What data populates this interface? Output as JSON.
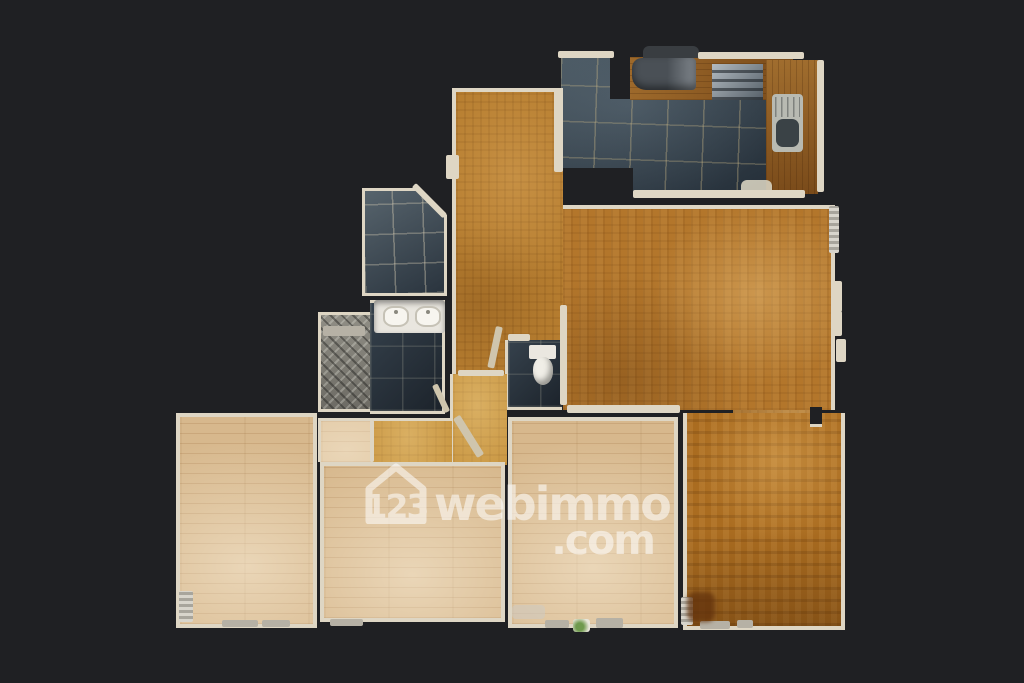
{
  "canvas": {
    "w": 1024,
    "h": 683,
    "bg": "#1f2023",
    "wall": "#ded6c4"
  },
  "watermark": {
    "num": "123",
    "brand": "webimmo",
    "tld": ".com",
    "color": "#ffffff",
    "opacity": 0.55,
    "x": 362,
    "y": 462,
    "w": 292
  },
  "rooms": [
    {
      "id": "passage-living-diningroom",
      "x": 733,
      "y": 403,
      "w": 79,
      "h": 22,
      "floor": "parquetLiving",
      "borders": ""
    },
    {
      "id": "kitchen-floor",
      "x": 561,
      "y": 57,
      "w": 232,
      "h": 137,
      "floor": "tileDark",
      "borders": "",
      "clip": "polygon(0px 0px, 49px 0px, 49px 42px, 69px 42px, 69px 0px, 232px 0px, 232px 137px, 72px 137px, 72px 111px, 0px 111px)"
    },
    {
      "id": "entry-hall",
      "x": 452,
      "y": 88,
      "w": 111,
      "h": 287,
      "floor": "parquetEntry",
      "borders": "t l",
      "bw": 4
    },
    {
      "id": "living-room",
      "x": 563,
      "y": 205,
      "w": 272,
      "h": 205,
      "floor": "parquetLiving",
      "borders": "t r",
      "bw": 4
    },
    {
      "id": "tiled-room",
      "x": 362,
      "y": 188,
      "w": 85,
      "h": 108,
      "floor": "tileMid",
      "borders": "t l b r",
      "bw": 3,
      "clip": "polygon(0px 0px, 58px 0px, 85px 27px, 85px 108px, 0px 108px)"
    },
    {
      "id": "shower",
      "x": 318,
      "y": 312,
      "w": 52,
      "h": 100,
      "floor": "shower",
      "borders": "t l b",
      "bw": 3
    },
    {
      "id": "bathroom-floor",
      "x": 370,
      "y": 300,
      "w": 75,
      "h": 114,
      "floor": "tileNavy",
      "borders": "t r b",
      "bw": 3
    },
    {
      "id": "wc-room",
      "x": 505,
      "y": 340,
      "w": 57,
      "h": 70,
      "floor": "tileNavy",
      "borders": "l b",
      "bw": 3
    },
    {
      "id": "corridor-vertical",
      "x": 450,
      "y": 374,
      "w": 57,
      "h": 91,
      "floor": "corridor",
      "borders": "l",
      "bw": 3
    },
    {
      "id": "corridor-horizontal",
      "x": 372,
      "y": 418,
      "w": 80,
      "h": 47,
      "floor": "corridor",
      "borders": "t",
      "bw": 3
    },
    {
      "id": "bedroom1-nook",
      "x": 318,
      "y": 418,
      "w": 54,
      "h": 44,
      "floor": "plank",
      "borders": "t l",
      "bw": 3
    },
    {
      "id": "bedroom1",
      "x": 176,
      "y": 413,
      "w": 141,
      "h": 215,
      "floor": "plank",
      "borders": "t l b r",
      "bw": 4
    },
    {
      "id": "bedroom2",
      "x": 320,
      "y": 462,
      "w": 185,
      "h": 160,
      "floor": "plank",
      "borders": "t l b r",
      "bw": 4
    },
    {
      "id": "bedroom3",
      "x": 508,
      "y": 417,
      "w": 170,
      "h": 211,
      "floor": "plank",
      "borders": "t l b r",
      "bw": 4
    },
    {
      "id": "dining-room-bottom-right",
      "x": 683,
      "y": 413,
      "w": 162,
      "h": 217,
      "floor": "parquetDeep",
      "borders": "l b r",
      "bw": 4
    },
    {
      "id": "kitchen-counter-top",
      "x": 630,
      "y": 57,
      "w": 163,
      "h": 43,
      "floor": "woodCounter",
      "borders": ""
    },
    {
      "id": "kitchen-counter-right",
      "x": 766,
      "y": 60,
      "w": 52,
      "h": 134,
      "floor": "woodCounterV",
      "borders": ""
    }
  ],
  "fixtures": [
    {
      "id": "hood-shadow",
      "x": 643,
      "y": 46,
      "w": 56,
      "h": 12,
      "cls": "patchGrey"
    },
    {
      "id": "cooker-hood",
      "x": 632,
      "y": 58,
      "w": 64,
      "h": 32,
      "cls": "hood"
    },
    {
      "id": "cooktop",
      "x": 712,
      "y": 64,
      "w": 51,
      "h": 36,
      "cls": "hob"
    },
    {
      "id": "kitchen-sink",
      "x": 772,
      "y": 94,
      "w": 31,
      "h": 58,
      "cls": "sinkUnit"
    },
    {
      "id": "kitchen-mat",
      "x": 741,
      "y": 180,
      "w": 31,
      "h": 16,
      "cls": "mat"
    },
    {
      "id": "wall-kitchen-top-left",
      "x": 558,
      "y": 51,
      "w": 56,
      "h": 7,
      "cls": "wall"
    },
    {
      "id": "wall-kitchen-top-right",
      "x": 698,
      "y": 52,
      "w": 106,
      "h": 7,
      "cls": "wall"
    },
    {
      "id": "wall-kitchen-right",
      "x": 817,
      "y": 60,
      "w": 7,
      "h": 132,
      "cls": "wall"
    },
    {
      "id": "threshold-entry-kitchen",
      "x": 554,
      "y": 88,
      "w": 9,
      "h": 84,
      "cls": "wall"
    },
    {
      "id": "wall-kitchen-bottom",
      "x": 633,
      "y": 190,
      "w": 172,
      "h": 8,
      "cls": "wall"
    },
    {
      "id": "wall-entry-notch",
      "x": 446,
      "y": 155,
      "w": 13,
      "h": 24,
      "cls": "wall"
    },
    {
      "id": "wall-wc-living",
      "x": 560,
      "y": 305,
      "w": 7,
      "h": 100,
      "cls": "wall"
    },
    {
      "id": "wall-living-bottom-left",
      "x": 567,
      "y": 405,
      "w": 113,
      "h": 8,
      "cls": "wall"
    },
    {
      "id": "threshold-corridor",
      "x": 458,
      "y": 370,
      "w": 46,
      "h": 6,
      "cls": "wall"
    },
    {
      "id": "wall-nook-door",
      "x": 370,
      "y": 420,
      "w": 4,
      "h": 42,
      "cls": "wall"
    },
    {
      "id": "wall-wc-top",
      "x": 508,
      "y": 334,
      "w": 22,
      "h": 7,
      "cls": "wall"
    },
    {
      "id": "wall-tiledroom-diagonal",
      "x": 416,
      "y": 183,
      "w": 44,
      "h": 6,
      "cls": "wall",
      "rot": 45
    },
    {
      "id": "door-bathroom",
      "x": 432,
      "y": 386,
      "w": 6,
      "h": 30,
      "cls": "wall2",
      "rot": -25
    },
    {
      "id": "door-wc",
      "x": 496,
      "y": 326,
      "w": 7,
      "h": 42,
      "cls": "wall2",
      "rot": 12
    },
    {
      "id": "door-corridor",
      "x": 453,
      "y": 419,
      "w": 8,
      "h": 46,
      "cls": "wall2",
      "rot": -32
    },
    {
      "id": "vanity",
      "x": 374,
      "y": 300,
      "w": 71,
      "h": 33,
      "cls": "vanity"
    },
    {
      "id": "vanity-basin-left",
      "x": 383,
      "y": 306,
      "w": 26,
      "h": 21,
      "cls": "basin"
    },
    {
      "id": "vanity-basin-right",
      "x": 415,
      "y": 306,
      "w": 26,
      "h": 21,
      "cls": "basin"
    },
    {
      "id": "shower-step",
      "x": 323,
      "y": 326,
      "w": 42,
      "h": 10,
      "cls": "sill"
    },
    {
      "id": "toilet-tank",
      "x": 529,
      "y": 345,
      "w": 27,
      "h": 14,
      "cls": "white"
    },
    {
      "id": "toilet-bowl",
      "x": 533,
      "y": 357,
      "w": 20,
      "h": 28,
      "cls": "toilet"
    },
    {
      "id": "radiator-living",
      "x": 829,
      "y": 206,
      "w": 10,
      "h": 47,
      "cls": "radiator"
    },
    {
      "id": "window-living-1",
      "x": 833,
      "y": 281,
      "w": 9,
      "h": 31,
      "cls": "wall"
    },
    {
      "id": "window-living-2",
      "x": 833,
      "y": 311,
      "w": 9,
      "h": 25,
      "cls": "wall"
    },
    {
      "id": "window-living-3",
      "x": 836,
      "y": 339,
      "w": 10,
      "h": 23,
      "cls": "wall"
    },
    {
      "id": "wall-stub-diningroom",
      "x": 810,
      "y": 407,
      "w": 12,
      "h": 20,
      "cls": "stub"
    },
    {
      "id": "radiator-bedroom1",
      "x": 179,
      "y": 591,
      "w": 14,
      "h": 31,
      "cls": "radiator"
    },
    {
      "id": "sill-bedroom1-a",
      "x": 222,
      "y": 620,
      "w": 36,
      "h": 7,
      "cls": "sill"
    },
    {
      "id": "sill-bedroom1-b",
      "x": 262,
      "y": 620,
      "w": 28,
      "h": 7,
      "cls": "sill"
    },
    {
      "id": "sill-bedroom2",
      "x": 330,
      "y": 619,
      "w": 33,
      "h": 7,
      "cls": "sill"
    },
    {
      "id": "sill-bedroom3-a",
      "x": 545,
      "y": 620,
      "w": 24,
      "h": 8,
      "cls": "sill"
    },
    {
      "id": "sill-bedroom3-b",
      "x": 596,
      "y": 618,
      "w": 27,
      "h": 10,
      "cls": "sill"
    },
    {
      "id": "plant-bedroom3",
      "x": 573,
      "y": 619,
      "w": 17,
      "h": 13,
      "cls": "plant"
    },
    {
      "id": "patch-bedroom3",
      "x": 512,
      "y": 605,
      "w": 33,
      "h": 14,
      "cls": "patchLight"
    },
    {
      "id": "radiator-diningroom",
      "x": 681,
      "y": 597,
      "w": 12,
      "h": 28,
      "cls": "radiator"
    },
    {
      "id": "sill-diningroom-a",
      "x": 700,
      "y": 621,
      "w": 30,
      "h": 8,
      "cls": "sill"
    },
    {
      "id": "sill-diningroom-b",
      "x": 737,
      "y": 620,
      "w": 16,
      "h": 8,
      "cls": "sill"
    },
    {
      "id": "patch-diningroom",
      "x": 687,
      "y": 592,
      "w": 28,
      "h": 30,
      "cls": "patchDark"
    }
  ]
}
